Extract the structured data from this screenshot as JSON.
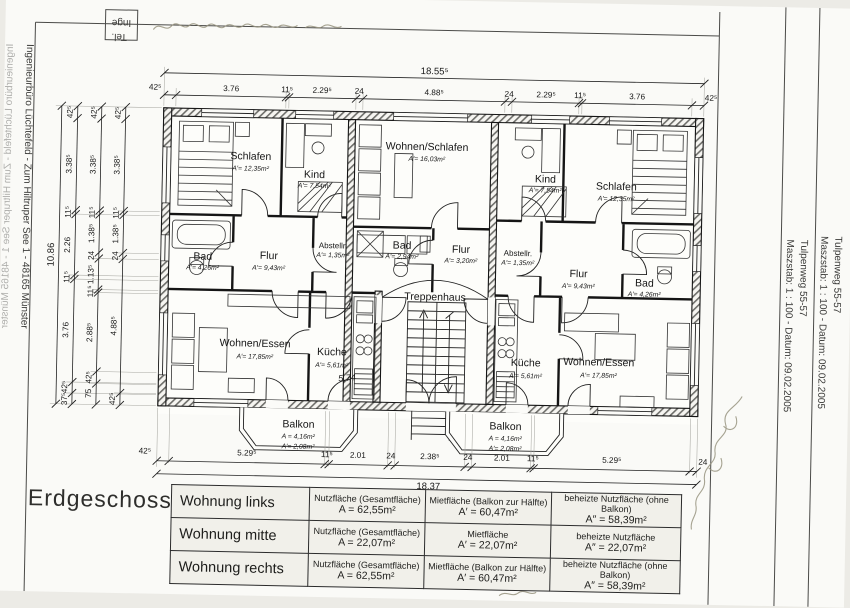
{
  "sheet": {
    "floor_title": "Erdgeschoss"
  },
  "margins": {
    "left_text": "Ingenieurbüro Lüchtefeld  -  Zum Hiltruper See 1  -  48165 Münster",
    "corner_top": "Inge",
    "corner_bottom": "Tel.",
    "strip1_project": "Tulpenweg 55-57",
    "strip1_meta": "Maszstab: 1 : 100   -   Datum: 09.02.2005",
    "strip2_project": "Tulpenweg 55-57",
    "strip2_meta": "Maszstab: 1 : 100   -   Datum: 09.02.2005"
  },
  "rooms": {
    "schlafen_l": {
      "name": "Schlafen",
      "area": "A′= 12,35m²"
    },
    "kind_l": {
      "name": "Kind",
      "area": "A′= 7,54m²"
    },
    "wohnen_schlafen": {
      "name": "Wohnen/Schlafen",
      "area": "A′= 16,03m²"
    },
    "kind_r": {
      "name": "Kind",
      "area": "A′= 7,54m²"
    },
    "schlafen_r": {
      "name": "Schlafen",
      "area": "A′= 12,35m²"
    },
    "bad_l": {
      "name": "Bad",
      "area": "A′= 4,26m²"
    },
    "flur_l": {
      "name": "Flur",
      "area": "A′= 9,43m²"
    },
    "abstell_l": {
      "name": "Abstellr.",
      "area": "A′= 1,35m²"
    },
    "bad_m": {
      "name": "Bad",
      "area": "A′= 2,94m²"
    },
    "flur_m": {
      "name": "Flur",
      "area": "A′= 3,20m²"
    },
    "abstell_r": {
      "name": "Abstellr.",
      "area": "A′= 1,35m²"
    },
    "flur_r": {
      "name": "Flur",
      "area": "A′= 9,43m²"
    },
    "bad_r": {
      "name": "Bad",
      "area": "A′= 4,26m²"
    },
    "wohnen_essen_l": {
      "name": "Wohnen/Essen",
      "area": "A′= 17,85m²"
    },
    "kueche_l": {
      "name": "Küche",
      "area": "A′= 5,61m²",
      "handwritten": "5,74"
    },
    "treppenhaus": {
      "name": "Treppenhaus"
    },
    "kueche_r": {
      "name": "Küche",
      "area": "A′= 5,61m²"
    },
    "wohnen_essen_r": {
      "name": "Wohnen/Essen",
      "area": "A′= 17,85m²"
    },
    "balkon_l": {
      "name": "Balkon",
      "area1": "A = 4,16m²",
      "area2": "A′= 2,08m²"
    },
    "balkon_r": {
      "name": "Balkon",
      "area1": "A = 4,16m²",
      "area2": "A′= 2,08m²"
    }
  },
  "dims": {
    "top_total": "18.55⁵",
    "top": [
      "42⁵",
      "3.76",
      "11⁵",
      "2.29⁵",
      "24",
      "4.88⁵",
      "24",
      "2.29⁵",
      "11⁵",
      "3.76",
      "42⁵"
    ],
    "bottom": [
      "42⁵",
      "5.29⁵",
      "11⁵",
      "2.01",
      "24",
      "2.38⁵",
      "24",
      "2.01",
      "11⁵",
      "5.29⁵",
      "24"
    ],
    "bottom_total": "18.37",
    "left_outer": [
      "42⁵",
      "3.38⁵",
      "11⁵",
      "2.26",
      "11⁵",
      "3.76",
      "42⁵",
      "37⁵"
    ],
    "left_middle": [
      "42⁵",
      "3.38⁵",
      "11⁵",
      "1.38⁵",
      "24",
      "1.13⁵",
      "11⁵",
      "2.88⁵",
      "42⁵",
      "75"
    ],
    "left_inner": [
      "42⁵",
      "3.38⁵",
      "11⁵",
      "1.38⁵",
      "24",
      "4.88⁵",
      "42⁵"
    ],
    "left_total": "10.86"
  },
  "table": {
    "rows": [
      {
        "apartment": "Wohnung links",
        "nutz_label": "Nutzfläche (Gesamtfläche)",
        "nutz_value": "A = 62,55m²",
        "miet_label": "Mietfläche (Balkon zur Hälfte)",
        "miet_value": "A′ = 60,47m²",
        "beheizt_label": "beheizte Nutzfläche (ohne Balkon)",
        "beheizt_value": "A″ = 58,39m²"
      },
      {
        "apartment": "Wohnung mitte",
        "nutz_label": "Nutzfläche (Gesamtfläche)",
        "nutz_value": "A = 22,07m²",
        "miet_label": "Mietfläche",
        "miet_value": "A′ = 22,07m²",
        "beheizt_label": "beheizte Nutzfläche",
        "beheizt_value": "A″ = 22,07m²"
      },
      {
        "apartment": "Wohnung rechts",
        "nutz_label": "Nutzfläche (Gesamtfläche)",
        "nutz_value": "A = 62,55m²",
        "miet_label": "Mietfläche (Balkon zur Hälfte)",
        "miet_value": "A′ = 60,47m²",
        "beheizt_label": "beheizte Nutzfläche (ohne Balkon)",
        "beheizt_value": "A″ = 58,39m²"
      }
    ]
  }
}
